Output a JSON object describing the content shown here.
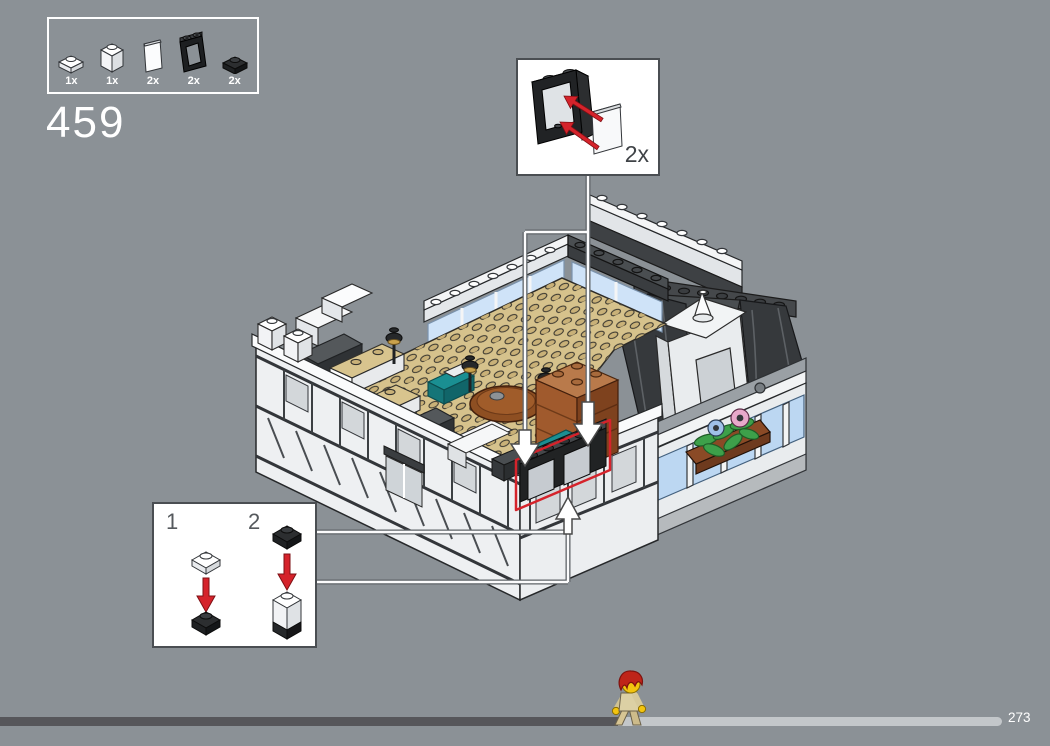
{
  "step": {
    "number": "459"
  },
  "parts_panel": {
    "parts": [
      {
        "name": "plate-1x1-white",
        "qty": "1x"
      },
      {
        "name": "brick-1x1-white",
        "qty": "1x"
      },
      {
        "name": "panel-glass-white",
        "qty": "2x"
      },
      {
        "name": "window-frame-1x2x2-black",
        "qty": "2x"
      },
      {
        "name": "plate-1x1-black",
        "qty": "2x"
      }
    ]
  },
  "callout": {
    "quantity": "2x",
    "part": "window-frame-with-glass-panel"
  },
  "substeps": {
    "labels": [
      "1",
      "2"
    ]
  },
  "progress": {
    "label": "273",
    "filled_px": 618,
    "track_px": 1002
  },
  "colors": {
    "background": "#8b9196",
    "accent_red": "#d5232b",
    "progress_filled": "#56565a",
    "progress_empty": "#c3c7ca",
    "panel_border": "#ffffff"
  }
}
